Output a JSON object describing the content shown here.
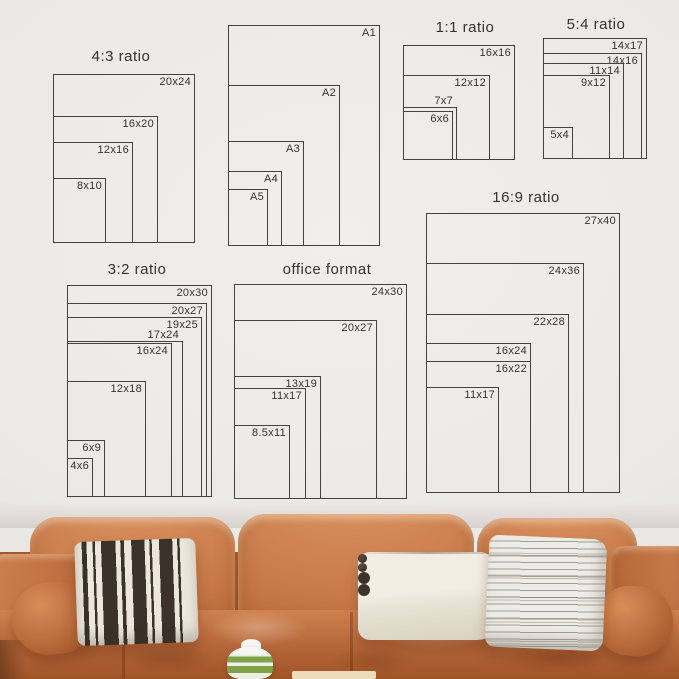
{
  "image_title": "poster and frame size guide above leather sofa",
  "diagram": {
    "line_color": "#45433f",
    "text_color": "#35332f",
    "groups": [
      {
        "name": "4-3-ratio",
        "title": "4:3 ratio",
        "title_center_x": 121,
        "title_top": 48,
        "left": 53,
        "bottom": 243,
        "items": [
          {
            "label": "20x24",
            "w": 142,
            "h": 169
          },
          {
            "label": "16x20",
            "w": 105,
            "h": 127
          },
          {
            "label": "12x16",
            "w": 80,
            "h": 101
          },
          {
            "label": "8x10",
            "w": 53,
            "h": 65
          }
        ]
      },
      {
        "name": "a-series",
        "title": "",
        "left": 228,
        "bottom": 246,
        "items": [
          {
            "label": "A1",
            "w": 152,
            "h": 221
          },
          {
            "label": "A2",
            "w": 112,
            "h": 161
          },
          {
            "label": "A3",
            "w": 76,
            "h": 105
          },
          {
            "label": "A4",
            "w": 54,
            "h": 75
          },
          {
            "label": "A5",
            "w": 40,
            "h": 57
          }
        ]
      },
      {
        "name": "1-1-ratio",
        "title": "1:1 ratio",
        "title_center_x": 465,
        "title_top": 19,
        "left": 403,
        "bottom": 160,
        "items": [
          {
            "label": "16x16",
            "w": 112,
            "h": 115
          },
          {
            "label": "12x12",
            "w": 87,
            "h": 85
          },
          {
            "label": "7x7",
            "w": 54,
            "h": 53,
            "label_outside": true
          },
          {
            "label": "6x6",
            "w": 50,
            "h": 49
          }
        ]
      },
      {
        "name": "5-4-ratio",
        "title": "5:4 ratio",
        "title_center_x": 596,
        "title_top": 16,
        "left": 543,
        "bottom": 159,
        "items": [
          {
            "label": "14x17",
            "w": 104,
            "h": 121
          },
          {
            "label": "14x16",
            "w": 99,
            "h": 106
          },
          {
            "label": "11x14",
            "w": 81,
            "h": 96
          },
          {
            "label": "9x12",
            "w": 67,
            "h": 84
          },
          {
            "label": "5x4",
            "w": 30,
            "h": 32
          }
        ]
      },
      {
        "name": "3-2-ratio",
        "title": "3:2 ratio",
        "title_center_x": 137,
        "title_top": 261,
        "left": 67,
        "bottom": 497,
        "items": [
          {
            "label": "20x30",
            "w": 145,
            "h": 212
          },
          {
            "label": "20x27",
            "w": 140,
            "h": 194
          },
          {
            "label": "19x25",
            "w": 135,
            "h": 180
          },
          {
            "label": "17x24",
            "w": 116,
            "h": 156,
            "label_outside": true
          },
          {
            "label": "16x24",
            "w": 105,
            "h": 154
          },
          {
            "label": "12x18",
            "w": 79,
            "h": 116
          },
          {
            "label": "6x9",
            "w": 38,
            "h": 57
          },
          {
            "label": "4x6",
            "w": 26,
            "h": 39
          }
        ]
      },
      {
        "name": "office-format",
        "title": "office format",
        "title_center_x": 327,
        "title_top": 261,
        "left": 234,
        "bottom": 499,
        "items": [
          {
            "label": "24x30",
            "w": 173,
            "h": 215
          },
          {
            "label": "20x27",
            "w": 143,
            "h": 179
          },
          {
            "label": "13x19",
            "w": 87,
            "h": 123
          },
          {
            "label": "11x17",
            "w": 72,
            "h": 111
          },
          {
            "label": "8.5x11",
            "w": 56,
            "h": 74
          }
        ]
      },
      {
        "name": "16-9-ratio",
        "title": "16:9 ratio",
        "title_center_x": 526,
        "title_top": 189,
        "left": 426,
        "bottom": 493,
        "items": [
          {
            "label": "27x40",
            "w": 194,
            "h": 280
          },
          {
            "label": "24x36",
            "w": 158,
            "h": 230
          },
          {
            "label": "22x28",
            "w": 143,
            "h": 179
          },
          {
            "label": "16x24",
            "w": 105,
            "h": 150
          },
          {
            "label": "16x22",
            "w": 105,
            "h": 132
          },
          {
            "label": "11x17",
            "w": 73,
            "h": 106
          }
        ]
      }
    ]
  },
  "photo": {
    "wall_color": "#ebe9e6",
    "sofa_color": "#c87a48",
    "sofa_light": "#d99160",
    "sofa_dark": "#a3582b",
    "pillow_bw_bg": "#ece7dd",
    "pillow_bw_stripe": "#3a322b",
    "pillow_lumbar_color": "#f1ede3",
    "pillow_gray_bg": "#eeece6",
    "vase_green": "#7fa24b",
    "table_color": "#ecdcba"
  }
}
